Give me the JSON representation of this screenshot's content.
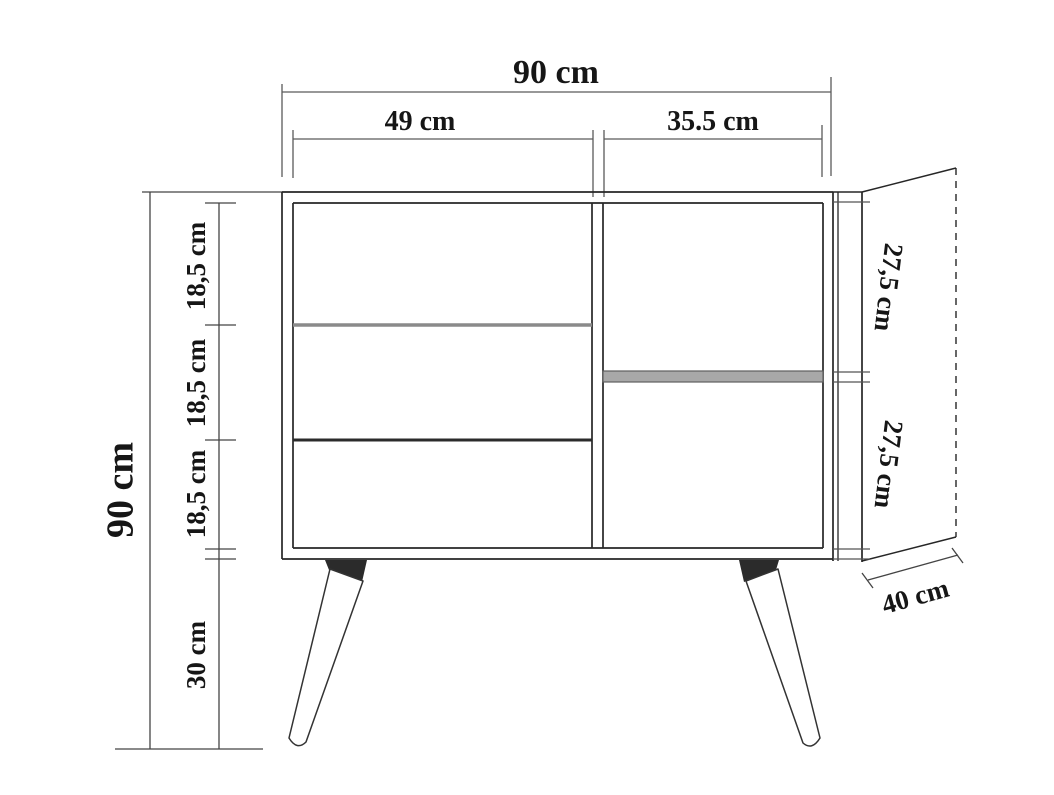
{
  "figure": {
    "kind": "furniture dimension diagram (sideboard front view with side panel in perspective and splayed legs)",
    "units": "cm",
    "background_color": "#ffffff",
    "outline_color": "#2a2a2a",
    "dimension_line_color": "#5a5a5a",
    "leg_bracket_color": "#2b2b2b"
  },
  "dims": {
    "overall_width": "90 cm",
    "left_section_width": "49 cm",
    "right_section_width": "35.5 cm",
    "overall_height": "90 cm",
    "drawer_heights": [
      "18,5 cm",
      "18,5 cm",
      "18,5 cm"
    ],
    "leg_height": "30 cm",
    "shelf_compartment_heights": [
      "27,5 cm",
      "27,5 cm"
    ],
    "depth": "40 cm"
  }
}
